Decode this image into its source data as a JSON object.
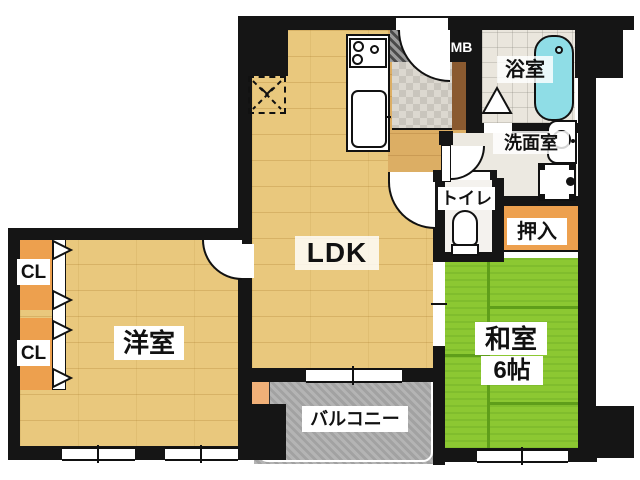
{
  "plan": {
    "type": "apartment-floor-plan",
    "rooms": {
      "ldk": {
        "label": "LDK"
      },
      "western": {
        "label": "洋室"
      },
      "japanese": {
        "label": "和室",
        "size_label": "6帖"
      },
      "balcony": {
        "label": "バルコニー"
      },
      "bath": {
        "label": "浴室"
      },
      "washroom": {
        "label": "洗面室"
      },
      "toilet": {
        "label": "トイレ"
      },
      "oshiire": {
        "label": "押入"
      },
      "closet1": {
        "label": "CL"
      },
      "closet2": {
        "label": "CL"
      },
      "meter_box": {
        "label": "MB"
      }
    },
    "icons": [
      "stove-icon",
      "sink-icon",
      "bathtub-icon",
      "vanity-sink-icon",
      "washer-pan-icon",
      "toilet-bowl-icon",
      "refrigerator-space-icon",
      "door-swing-icon",
      "folding-door-icon",
      "window-icon"
    ],
    "colors": {
      "wall": "#151515",
      "wood_floor": "#e9c87d",
      "hall_floor": "#dcae64",
      "tatami_green": "#8cc832",
      "tatami_line": "#5f9e1a",
      "closet_orange": "#eda04e",
      "balcony_gray": "#a9a9a9",
      "bathtub_cyan": "#8fdde6",
      "entry_tile": "#dcd8d0",
      "cabinet_brown": "#8a5a30",
      "background": "#ffffff"
    }
  }
}
